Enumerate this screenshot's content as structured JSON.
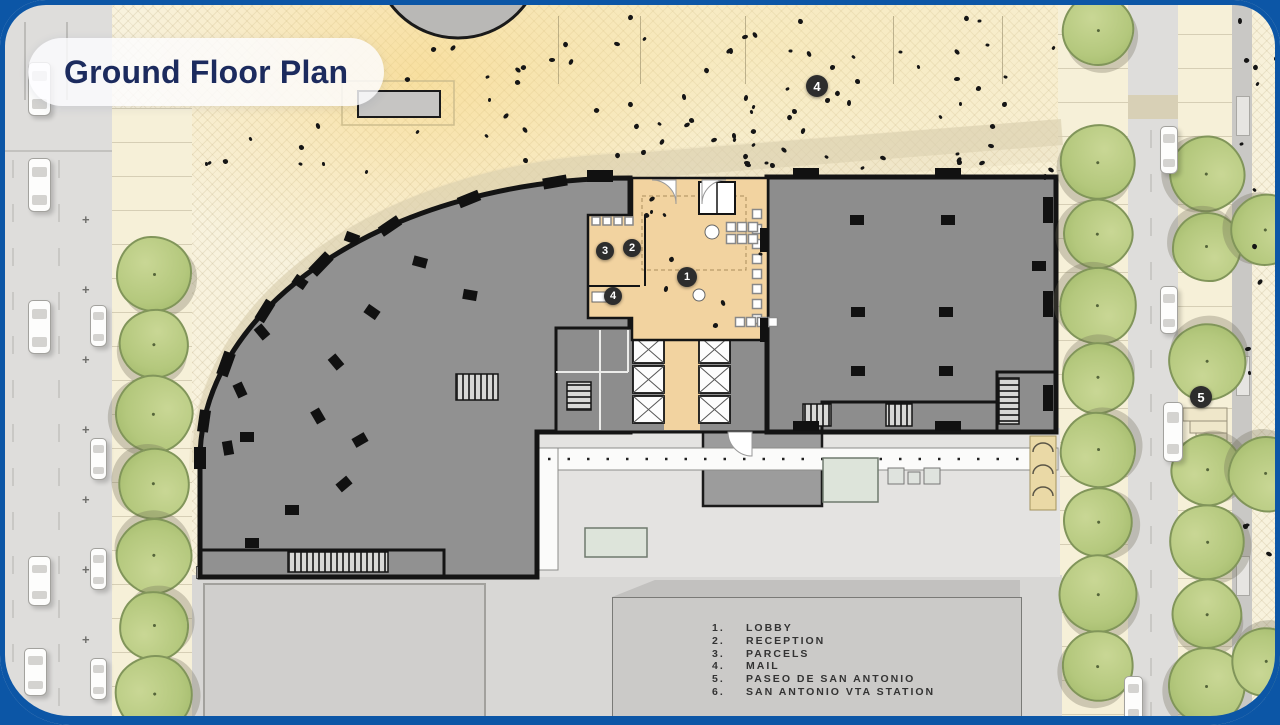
{
  "title": "Ground Floor Plan",
  "legend": {
    "items": [
      {
        "num": "1.",
        "label": "LOBBY"
      },
      {
        "num": "2.",
        "label": "RECEPTION"
      },
      {
        "num": "3.",
        "label": "PARCELS"
      },
      {
        "num": "4.",
        "label": "MAIL"
      },
      {
        "num": "5.",
        "label": "PASEO DE SAN ANTONIO"
      },
      {
        "num": "6.",
        "label": "SAN ANTONIO VTA STATION"
      }
    ]
  },
  "markers": {
    "lobby": {
      "n": "1"
    },
    "reception": {
      "n": "2"
    },
    "parcels": {
      "n": "3"
    },
    "mail": {
      "n": "4"
    },
    "plaza": {
      "n": "4"
    },
    "paseo": {
      "n": "5"
    }
  },
  "colors": {
    "frame_blue": "#0c56a6",
    "title_navy": "#1c2b5e",
    "lobby_tan": "#f2d3a0",
    "building_gray": "#8f8f8f",
    "wall_black": "#161616",
    "tree_green": "#b4c87d",
    "plaza_cream": "#f8f2dd"
  }
}
